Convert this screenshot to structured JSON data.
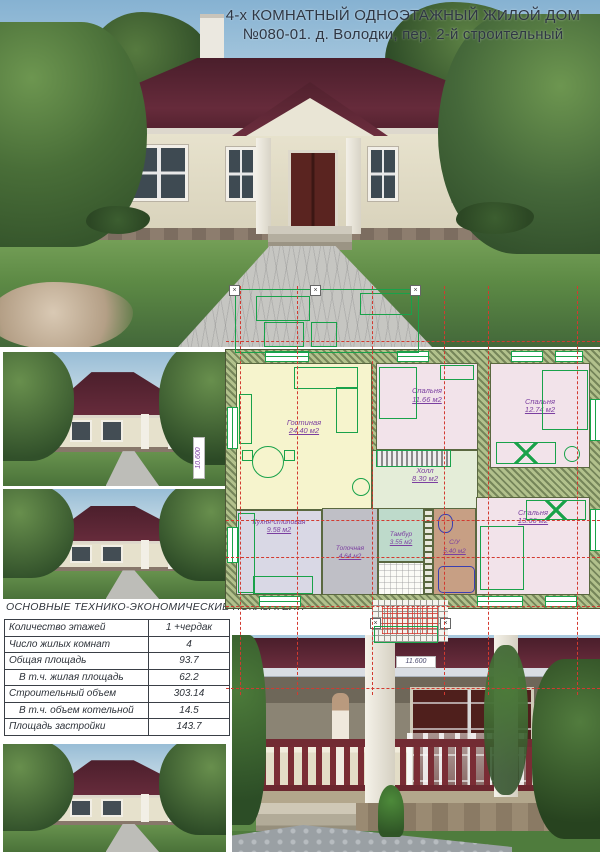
{
  "title": {
    "line1": "4-х КОМНАТНЫЙ ОДНОЭТАЖНЫЙ ЖИЛОЙ ДОМ",
    "line2": "№080-01.  д. Володки, пер. 2-й строительный"
  },
  "plan": {
    "rooms": [
      {
        "name": "Гостиная",
        "area": "24.40 м2"
      },
      {
        "name": "Спальня",
        "area": "11.66 м2"
      },
      {
        "name": "Спальня",
        "area": "12.74 м2"
      },
      {
        "name": "Холл",
        "area": "8.30 м2"
      },
      {
        "name": "Спальня",
        "area": "13.66 м2"
      },
      {
        "name": "Кухня-столовая",
        "area": "9.58 м2"
      },
      {
        "name": "Топочная",
        "area": "4.64 м2"
      },
      {
        "name": "Тамбур",
        "area": "3.55 м2"
      },
      {
        "name": "С/У",
        "area": "5.40 м2"
      }
    ],
    "dimensions": {
      "overall_width": "11.600",
      "overall_depth": "10.600"
    }
  },
  "table": {
    "caption": "ОСНОВНЫЕ ТЕХНИКО-ЭКОНОМИЧЕСКИЕ ПОКАЗАТЕЛИ",
    "rows": [
      {
        "label": "Количество этажей",
        "value": "1 +чердак",
        "indent": false
      },
      {
        "label": "Число жилых комнат",
        "value": "4",
        "indent": false
      },
      {
        "label": "Общая площадь",
        "value": "93.7",
        "indent": false
      },
      {
        "label": "В т.ч. жилая площадь",
        "value": "62.2",
        "indent": true
      },
      {
        "label": "Строительный объем",
        "value": "303.14",
        "indent": false
      },
      {
        "label": "В т.ч. объем котельной",
        "value": "14.5",
        "indent": true
      },
      {
        "label": "Площадь застройки",
        "value": "143.7",
        "indent": false
      }
    ]
  },
  "colors": {
    "roof": "#5c2736",
    "wall_beige": "#e6e1cd",
    "plan_green": "#19a24a",
    "grid_red": "#d23a30",
    "label_purple": "#7b3fa0",
    "living_fill": "#f6f4cd",
    "bedroom_fill": "#f2e3ea",
    "hall_fill": "#e4edd8",
    "kitchen_fill": "#d9d8e5",
    "boiler_fill": "#bfbfc6",
    "tambour_fill": "#bedacb",
    "bathroom_fill": "#c79f84",
    "wall_hatch": "#8a9a63"
  }
}
